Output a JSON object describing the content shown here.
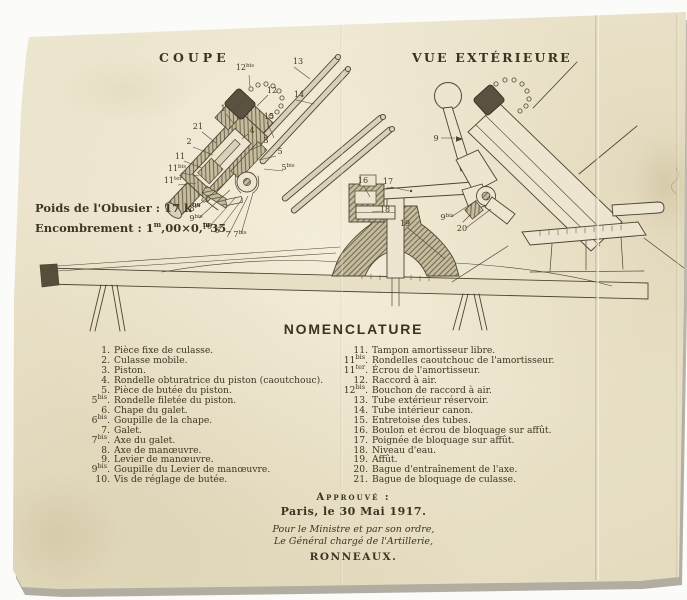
{
  "titles": {
    "coupe": "COUPE",
    "vue": "VUE EXTÉRIEURE"
  },
  "stats": {
    "poids": [
      {
        "t": "Poids de l'Obusier : 17 k"
      },
      {
        "s": "os"
      }
    ],
    "encombrement": [
      {
        "t": "Encombrement : 1"
      },
      {
        "s": "m"
      },
      {
        "t": ",00×0,"
      },
      {
        "s": "m"
      },
      {
        "t": "35"
      }
    ]
  },
  "nomenclature": {
    "title": "NOMENCLATURE",
    "left": [
      {
        "n": "1",
        "label": "Pièce fixe de culasse."
      },
      {
        "n": "2",
        "label": "Culasse mobile."
      },
      {
        "n": "3",
        "label": "Piston."
      },
      {
        "n": "4",
        "label": "Rondelle obturatrice du piston (caoutchouc)."
      },
      {
        "n": "5",
        "label": "Pièce de butée du piston."
      },
      {
        "n": "5",
        "s": "bis",
        "label": "Rondelle filetée du piston."
      },
      {
        "n": "6",
        "label": "Chape du galet."
      },
      {
        "n": "6",
        "s": "bis",
        "label": "Goupille de la chape."
      },
      {
        "n": "7",
        "label": "Galet."
      },
      {
        "n": "7",
        "s": "bis",
        "label": "Axe du galet."
      },
      {
        "n": "8",
        "label": "Axe de manœuvre."
      },
      {
        "n": "9",
        "label": "Levier de manœuvre."
      },
      {
        "n": "9",
        "s": "bis",
        "label": "Goupille du Levier de manœuvre."
      },
      {
        "n": "10",
        "label": "Vis de réglage de butée."
      }
    ],
    "right": [
      {
        "n": "11",
        "label": "Tampon amortisseur libre."
      },
      {
        "n": "11",
        "s": "bis",
        "label": "Rondelles caoutchouc de l'amortisseur."
      },
      {
        "n": "11",
        "s": "ter",
        "label": "Écrou de l'amortisseur."
      },
      {
        "n": "12",
        "label": "Raccord à air."
      },
      {
        "n": "12",
        "s": "bis",
        "label": "Bouchon de raccord à air."
      },
      {
        "n": "13",
        "label": "Tube extérieur réservoir."
      },
      {
        "n": "14",
        "label": "Tube intérieur canon."
      },
      {
        "n": "15",
        "label": "Entretoise des tubes."
      },
      {
        "n": "16",
        "label": "Boulon et écrou de bloquage sur affût."
      },
      {
        "n": "17",
        "label": "Poignée de bloquage sur affût."
      },
      {
        "n": "18",
        "label": "Niveau d'eau."
      },
      {
        "n": "19",
        "label": "Affût."
      },
      {
        "n": "20",
        "label": "Bague d'entraînement de l'axe."
      },
      {
        "n": "21",
        "label": "Bague de bloquage de culasse."
      }
    ]
  },
  "approval": {
    "approved_label": "Approuvé :",
    "place_date": "Paris, le 30 Mai 1917.",
    "minister_line": "Pour le Ministre et par son ordre,",
    "general_line": "Le Général chargé de l'Artillerie,",
    "signature": "RONNEAUX."
  },
  "colors": {
    "ink": "#4d4433",
    "paper": "#ebe4cc",
    "cap_dark": "#5a5241"
  },
  "diagram": {
    "callouts": [
      {
        "t": "12",
        "s": "bis",
        "x": 245,
        "y": 70
      },
      {
        "t": "12",
        "x": 272,
        "y": 93
      },
      {
        "t": "13",
        "x": 298,
        "y": 64
      },
      {
        "t": "14",
        "x": 299,
        "y": 97
      },
      {
        "t": "15",
        "x": 269,
        "y": 119
      },
      {
        "t": "1",
        "x": 223,
        "y": 111
      },
      {
        "t": "21",
        "x": 198,
        "y": 129
      },
      {
        "t": "2",
        "x": 189,
        "y": 144
      },
      {
        "t": "11",
        "x": 180,
        "y": 159
      },
      {
        "t": "11",
        "s": "bis",
        "x": 177,
        "y": 171
      },
      {
        "t": "11",
        "s": "ter",
        "x": 173,
        "y": 183
      },
      {
        "t": "4",
        "x": 252,
        "y": 133
      },
      {
        "t": "3",
        "x": 266,
        "y": 143
      },
      {
        "t": "5",
        "x": 280,
        "y": 154
      },
      {
        "t": "5",
        "s": "bis",
        "x": 288,
        "y": 170
      },
      {
        "t": "8",
        "x": 192,
        "y": 211
      },
      {
        "t": "9",
        "s": "bis",
        "x": 196,
        "y": 221
      },
      {
        "t": "10",
        "x": 207,
        "y": 229
      },
      {
        "t": "6",
        "x": 217,
        "y": 233
      },
      {
        "t": "7",
        "x": 228,
        "y": 237
      },
      {
        "t": "7",
        "s": "bis",
        "x": 240,
        "y": 237
      },
      {
        "t": "16",
        "x": 363,
        "y": 183
      },
      {
        "t": "17",
        "x": 388,
        "y": 184
      },
      {
        "t": "18",
        "x": 385,
        "y": 212
      },
      {
        "t": "19",
        "x": 405,
        "y": 226
      },
      {
        "t": "9",
        "x": 436,
        "y": 141
      },
      {
        "t": "9",
        "s": "bis",
        "x": 447,
        "y": 220
      },
      {
        "t": "20",
        "x": 462,
        "y": 231
      }
    ],
    "leaders": [
      [
        249,
        75,
        250,
        87
      ],
      [
        268,
        95,
        257,
        106
      ],
      [
        294,
        67,
        310,
        79
      ],
      [
        296,
        100,
        314,
        104
      ],
      [
        267,
        122,
        274,
        138
      ],
      [
        226,
        114,
        234,
        124
      ],
      [
        202,
        132,
        216,
        143
      ],
      [
        193,
        147,
        213,
        155
      ],
      [
        184,
        161,
        202,
        168
      ],
      [
        181,
        173,
        199,
        176
      ],
      [
        178,
        185,
        196,
        183
      ],
      [
        248,
        134,
        242,
        139
      ],
      [
        262,
        145,
        250,
        150
      ],
      [
        276,
        156,
        259,
        160
      ],
      [
        283,
        171,
        264,
        169
      ],
      [
        195,
        208,
        224,
        184
      ],
      [
        199,
        218,
        230,
        190
      ],
      [
        210,
        226,
        236,
        197
      ],
      [
        219,
        230,
        243,
        198
      ],
      [
        229,
        234,
        248,
        196
      ],
      [
        241,
        234,
        253,
        193
      ],
      [
        364,
        186,
        370,
        197
      ],
      [
        391,
        187,
        409,
        191
      ],
      [
        381,
        211,
        372,
        212
      ],
      [
        408,
        228,
        445,
        259
      ],
      [
        441,
        138,
        455,
        138
      ],
      [
        451,
        217,
        477,
        200
      ],
      [
        466,
        228,
        491,
        209
      ]
    ]
  }
}
